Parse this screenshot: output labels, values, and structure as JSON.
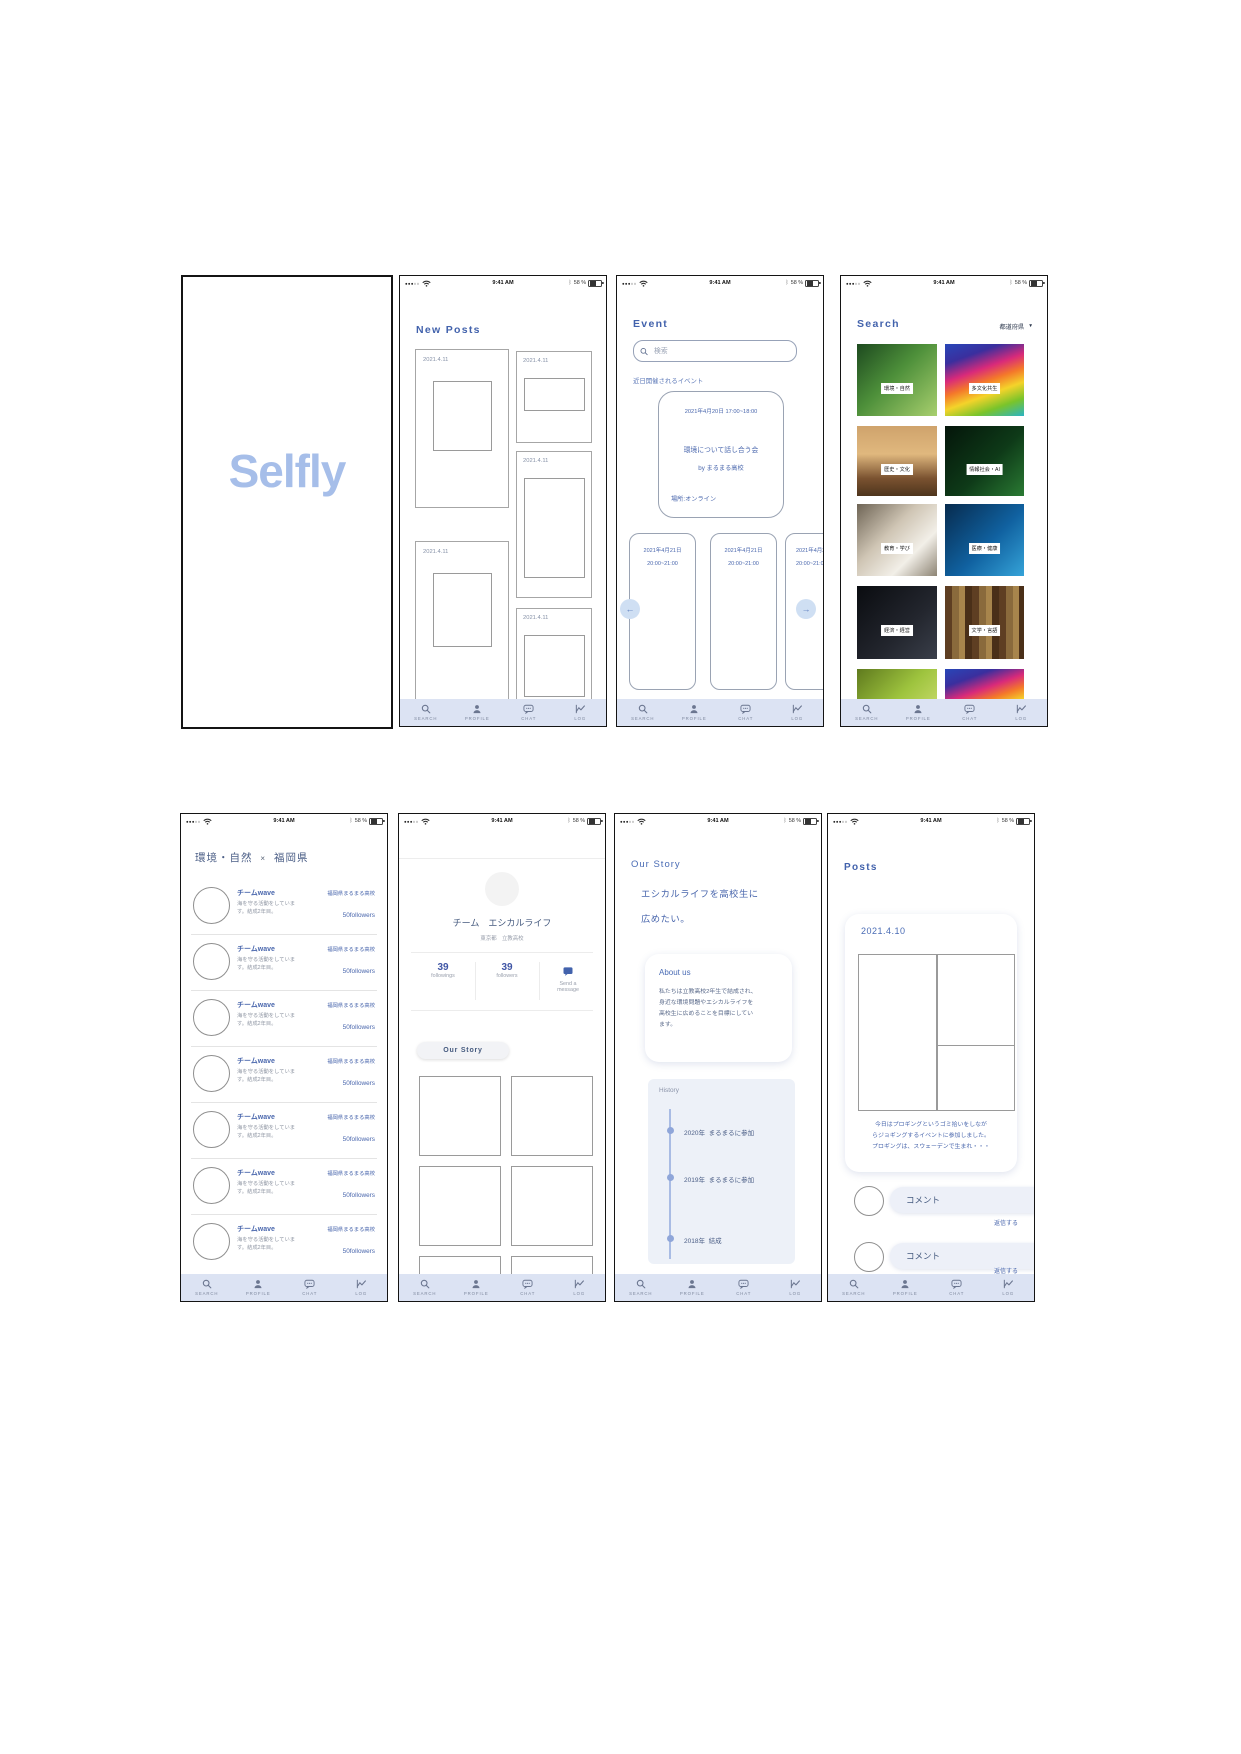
{
  "app": {
    "name": "Selfly"
  },
  "colors": {
    "accent": "#4a67ad",
    "heading": "#4262ac",
    "nav_bg": "#dce3f3",
    "logo": "#a6bee9",
    "muted": "#9aa0ad",
    "history_bg": "#edf1f8"
  },
  "status_bar": {
    "signal_dots": "●●●○○",
    "time": "9:41 AM",
    "bluetooth": "ᛒ",
    "battery_percent": "58 %"
  },
  "nav": {
    "items": [
      {
        "label": "SEARCH"
      },
      {
        "label": "PROFILE"
      },
      {
        "label": "CHAT"
      },
      {
        "label": "LOG"
      }
    ]
  },
  "splash": {
    "logo_text": "Selfly"
  },
  "new_posts": {
    "title": "New Posts",
    "posts": [
      {
        "date": "2021.4.11"
      },
      {
        "date": "2021.4.11"
      },
      {
        "date": "2021.4.11"
      },
      {
        "date": "2021.4.11"
      },
      {
        "date": "2021.4.11"
      }
    ]
  },
  "event": {
    "title": "Event",
    "search_placeholder": "検索",
    "section_label": "近日開催されるイベント",
    "featured": {
      "datetime": "2021年4月20日 17:00~18:00",
      "name": "環境について話し合う会",
      "host": "by まるまる高校",
      "place": "場所:オンライン"
    },
    "upcoming": [
      {
        "date": "2021年4月21日",
        "time": "20:00~21:00"
      },
      {
        "date": "2021年4月21日",
        "time": "20:00~21:00"
      },
      {
        "date": "2021年4月21日",
        "time": "20:00~21:00"
      }
    ],
    "prev_arrow": "←",
    "next_arrow": "→"
  },
  "search": {
    "title": "Search",
    "filter_label": "都道府県",
    "filter_arrow": "▼",
    "categories": [
      {
        "label": "環境・自然"
      },
      {
        "label": "多文化共生"
      },
      {
        "label": "歴史・文化"
      },
      {
        "label": "情報社会・AI"
      },
      {
        "label": "教育・学び"
      },
      {
        "label": "医療・健康"
      },
      {
        "label": "経済・経営"
      },
      {
        "label": "文学・言語"
      }
    ]
  },
  "team_list": {
    "title_left": "環境・自然",
    "title_x": "×",
    "title_right": "福岡県",
    "rows": [
      {
        "name": "チームwave",
        "desc_line1": "海を守る活動をしていま",
        "desc_line2": "す。結成2年目。",
        "school": "福岡県まるまる高校",
        "followers": "50followers"
      },
      {
        "name": "チームwave",
        "desc_line1": "海を守る活動をしていま",
        "desc_line2": "す。結成2年目。",
        "school": "福岡県まるまる高校",
        "followers": "50followers"
      },
      {
        "name": "チームwave",
        "desc_line1": "海を守る活動をしていま",
        "desc_line2": "す。結成2年目。",
        "school": "福岡県まるまる高校",
        "followers": "50followers"
      },
      {
        "name": "チームwave",
        "desc_line1": "海を守る活動をしていま",
        "desc_line2": "す。結成2年目。",
        "school": "福岡県まるまる高校",
        "followers": "50followers"
      },
      {
        "name": "チームwave",
        "desc_line1": "海を守る活動をしていま",
        "desc_line2": "す。結成2年目。",
        "school": "福岡県まるまる高校",
        "followers": "50followers"
      },
      {
        "name": "チームwave",
        "desc_line1": "海を守る活動をしていま",
        "desc_line2": "す。結成2年目。",
        "school": "福岡県まるまる高校",
        "followers": "50followers"
      },
      {
        "name": "チームwave",
        "desc_line1": "海を守る活動をしていま",
        "desc_line2": "す。結成2年目。",
        "school": "福岡県まるまる高校",
        "followers": "50followers"
      }
    ]
  },
  "profile": {
    "team_name": "チーム　エシカルライフ",
    "school": "東京都　立教高校",
    "stats": {
      "followings_value": "39",
      "followings_label": "followings",
      "followers_value": "39",
      "followers_label": "followers",
      "message_line1": "Send a",
      "message_line2": "message"
    },
    "our_story_button": "Our Story"
  },
  "our_story": {
    "title": "Our Story",
    "headline_line1": "エシカルライフを高校生に",
    "headline_line2": "広めたい。",
    "about": {
      "title": "About us",
      "line1": "私たちは立教高校2年生で結成され、",
      "line2": "身近な環境問題やエシカルライフを",
      "line3": "高校生に広めることを目標にしてい",
      "line4": "ます。"
    },
    "history": {
      "title": "History",
      "entries": [
        {
          "year": "2020年",
          "event": "まるまるに参加"
        },
        {
          "year": "2019年",
          "event": "まるまるに参加"
        },
        {
          "year": "2018年",
          "event": "結成"
        }
      ]
    }
  },
  "posts": {
    "title": "Posts",
    "post": {
      "date": "2021.4.10",
      "body_line1": "今日はプロギングというゴミ拾いをしなが",
      "body_line2": "らジョギングするイベントに参加しました。",
      "body_line3": "プロギングは、スウェーデンで生まれ・・・"
    },
    "comments": [
      {
        "placeholder": "コメント",
        "reply": "返信する"
      },
      {
        "placeholder": "コメント",
        "reply": "返信する"
      }
    ]
  }
}
